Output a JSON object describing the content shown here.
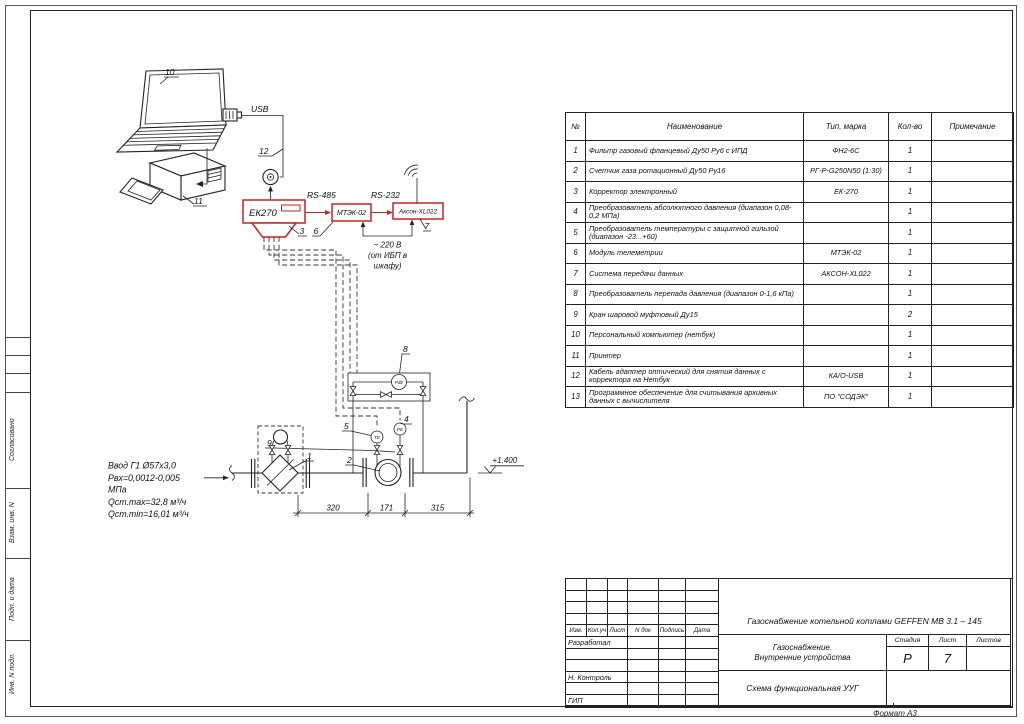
{
  "page": {
    "format_note": "Формат А3"
  },
  "side_panel": {
    "labels": [
      "Согласовано",
      "Взам. инв. N",
      "Подп. и дата",
      "Инв. N подл."
    ]
  },
  "schematic": {
    "devices": {
      "corrector": "ЕК270",
      "telemetry": "МТЭК-02",
      "transmission": "Аксон-XL022",
      "dp_tag": "PdE",
      "temp_tag": "ТЕ",
      "press_tag": "РЕ"
    },
    "links": {
      "usb": "USB",
      "rs485": "RS-485",
      "rs232": "RS-232"
    },
    "power_note": [
      "~ 220 В",
      "(от ИБП в",
      "шкафу)"
    ],
    "elevation": "+1.400",
    "callouts": {
      "filter": "1",
      "meter": "2",
      "corrector": "3",
      "pressure": "4",
      "temperature": "5",
      "telemetry": "6",
      "transmission": "7",
      "dp": "8",
      "valves": "9",
      "laptop": "10",
      "printer": "11",
      "cable": "12"
    },
    "dimensions": [
      "320",
      "171",
      "315"
    ],
    "inlet_note": [
      "Ввод Г1 Ø57х3,0",
      "Рвх=0,0012-0,005",
      "МПа",
      "Qст.max=32,8 м³/ч",
      "Qст.min=16,01 м³/ч"
    ]
  },
  "equipment_table": {
    "headers": {
      "num": "№",
      "name": "Наименование",
      "type": "Тип, марка",
      "qty": "Кол-во",
      "note": "Примечание"
    },
    "rows": [
      {
        "num": "1",
        "name": "Фильтр газовый фланцевый Ду50 Ру6 с ИПД",
        "type": "ФН2-6С",
        "qty": "1",
        "note": ""
      },
      {
        "num": "2",
        "name": "Счетчик газа ротационный Ду50 Ру16",
        "type": "РГ-Р-G250N50 (1:30)",
        "qty": "1",
        "note": ""
      },
      {
        "num": "3",
        "name": "Корректор электронный",
        "type": "ЕК-270",
        "qty": "1",
        "note": ""
      },
      {
        "num": "4",
        "name": "Преобразователь абсолютного давления (диапазон 0,08-0,2 МПа)",
        "type": "",
        "qty": "1",
        "note": ""
      },
      {
        "num": "5",
        "name": "Преобразователь температуры с защитной гильзой (диапазон -23...+60)",
        "type": "",
        "qty": "1",
        "note": ""
      },
      {
        "num": "6",
        "name": "Модуль телеметрии",
        "type": "МТЭК-02",
        "qty": "1",
        "note": ""
      },
      {
        "num": "7",
        "name": "Система передачи данных",
        "type": "АКСОН-XL022",
        "qty": "1",
        "note": ""
      },
      {
        "num": "8",
        "name": "Преобразователь перепада давления (диапазон 0-1,6 кПа)",
        "type": "",
        "qty": "1",
        "note": ""
      },
      {
        "num": "9",
        "name": "Кран шаровой муфтовый Ду15",
        "type": "",
        "qty": "2",
        "note": ""
      },
      {
        "num": "10",
        "name": "Персональный компьютер (нетбук)",
        "type": "",
        "qty": "1",
        "note": ""
      },
      {
        "num": "11",
        "name": "Принтер",
        "type": "",
        "qty": "1",
        "note": ""
      },
      {
        "num": "12",
        "name": "Кабель адаптер оптический для снятия данных с корректора на Нетбук",
        "type": "КА/О-USB",
        "qty": "1",
        "note": ""
      },
      {
        "num": "13",
        "name": "Программное обеспечение для считывания архивных данных с вычислителя",
        "type": "ПО \"СОДЭК\"",
        "qty": "1",
        "note": ""
      }
    ]
  },
  "title_block": {
    "project": "Газоснабжение котельной  котлами GEFFEN MB 3.1 – 145",
    "object": [
      "Газоснабжение.",
      "Внутренние устройства"
    ],
    "doc_title": "Схема функциональная УУГ",
    "stage": {
      "label": "Стадия",
      "value": "Р"
    },
    "sheet": {
      "label": "Лист",
      "value": "7"
    },
    "sheets": {
      "label": "Листов",
      "value": ""
    },
    "rev_columns": [
      "Изм.",
      "Кол.уч",
      "Лист",
      "N док",
      "Подпись",
      "Дата"
    ],
    "roles": [
      "Разработал",
      "",
      "",
      "Н. Контроль",
      "",
      "ГИП"
    ]
  }
}
